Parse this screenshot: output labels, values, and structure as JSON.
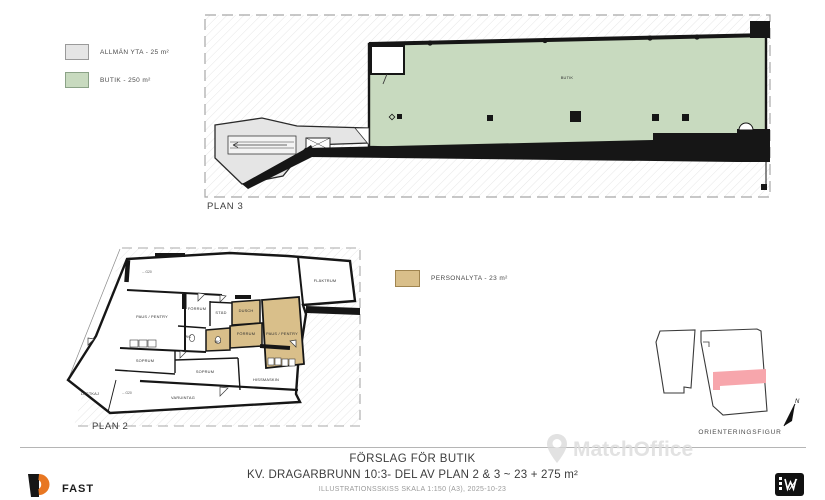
{
  "colors": {
    "butik_green": "#c8dabf",
    "allman_gray": "#e5e5e5",
    "personalyta_tan": "#d9bf8a",
    "highlight_pink": "#f7a6ac",
    "wall_black": "#161616",
    "accent_orange": "#e87722"
  },
  "legend_plan3": {
    "items": [
      {
        "label": "ALLMÄN YTA - 25 m²"
      },
      {
        "label": "BUTIK - 250 m²"
      }
    ]
  },
  "legend_plan2": {
    "items": [
      {
        "label": "PERSONALYTA - 23 m²"
      }
    ]
  },
  "plan3": {
    "caption": "PLAN 3",
    "room": "BUTIK"
  },
  "plan2": {
    "caption": "PLAN 2",
    "rooms": [
      "FLÄKTRUM",
      "PAUS / PENTRY",
      "FÖRRUM",
      "STÄD",
      "DUSCH",
      "FÖRRUM",
      "WC",
      "WC",
      "PAUS / PENTRY",
      "SOPRUM",
      "SOPRUM",
      "HISSMASKIN",
      "LASTKAJ",
      "VARUINTAG"
    ],
    "door_labels": [
      "←G20",
      "←G20"
    ]
  },
  "orientation": {
    "caption": "ORIENTERINGSFIGUR",
    "north_label": "N"
  },
  "watermark": {
    "text": "MatchOffice"
  },
  "title_block": {
    "title": "FÖRSLAG FÖR BUTIK",
    "subtitle": "KV. DRAGARBRUNN 10:3- DEL AV PLAN 2 & 3 ~ 23 + 275 m²",
    "note": "ILLUSTRATIONSSKISS SKALA 1:150 (A3), 2025-10-23",
    "firm": "FAST"
  }
}
